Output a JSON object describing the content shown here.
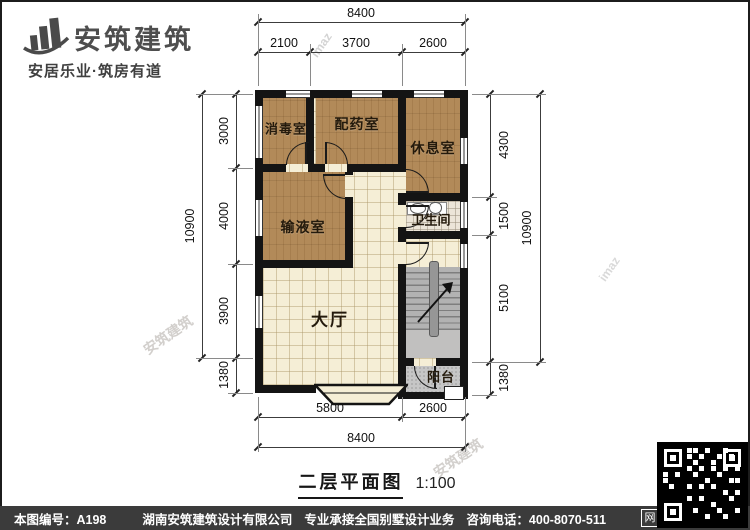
{
  "brand": {
    "name": "安筑建筑",
    "tagline": "安居乐业·筑房有道"
  },
  "plan": {
    "rooms": [
      {
        "id": "disinfection-room",
        "label": "消毒室"
      },
      {
        "id": "dispensary-room",
        "label": "配药室"
      },
      {
        "id": "rest-room",
        "label": "休息室"
      },
      {
        "id": "infusion-room",
        "label": "输液室"
      },
      {
        "id": "bathroom",
        "label": "卫生间"
      },
      {
        "id": "hall",
        "label": "大厅"
      },
      {
        "id": "balcony",
        "label": "阳台"
      }
    ]
  },
  "dimensions": {
    "top": {
      "overall": "8400",
      "segments": [
        "2100",
        "3700",
        "2600"
      ]
    },
    "bottom": {
      "overall": "8400",
      "segments": [
        "5800",
        "2600"
      ]
    },
    "left": {
      "overall": "10900",
      "segments": [
        "3000",
        "4000",
        "3900",
        "1380"
      ]
    },
    "right": {
      "overall": "10900",
      "segments": [
        "4300",
        "1500",
        "5100",
        "1380"
      ]
    }
  },
  "title": {
    "text": "二层平面图",
    "scale": "1:100"
  },
  "footer": {
    "drawing_no": "本图编号：A198",
    "company": "湖南安筑建筑设计有限公司",
    "service": "专业承接全国别墅设计业务",
    "phone": "咨询电话：400-8070-511",
    "web_badge": "网"
  },
  "watermarks": {
    "cn": "安筑建筑",
    "en": "imaz"
  },
  "colors": {
    "wall": "#141414",
    "wood": "#b28a59",
    "tile": "#f5eed6",
    "gray": "#c6c6c6",
    "footer_bg": "#3b3b3b"
  }
}
